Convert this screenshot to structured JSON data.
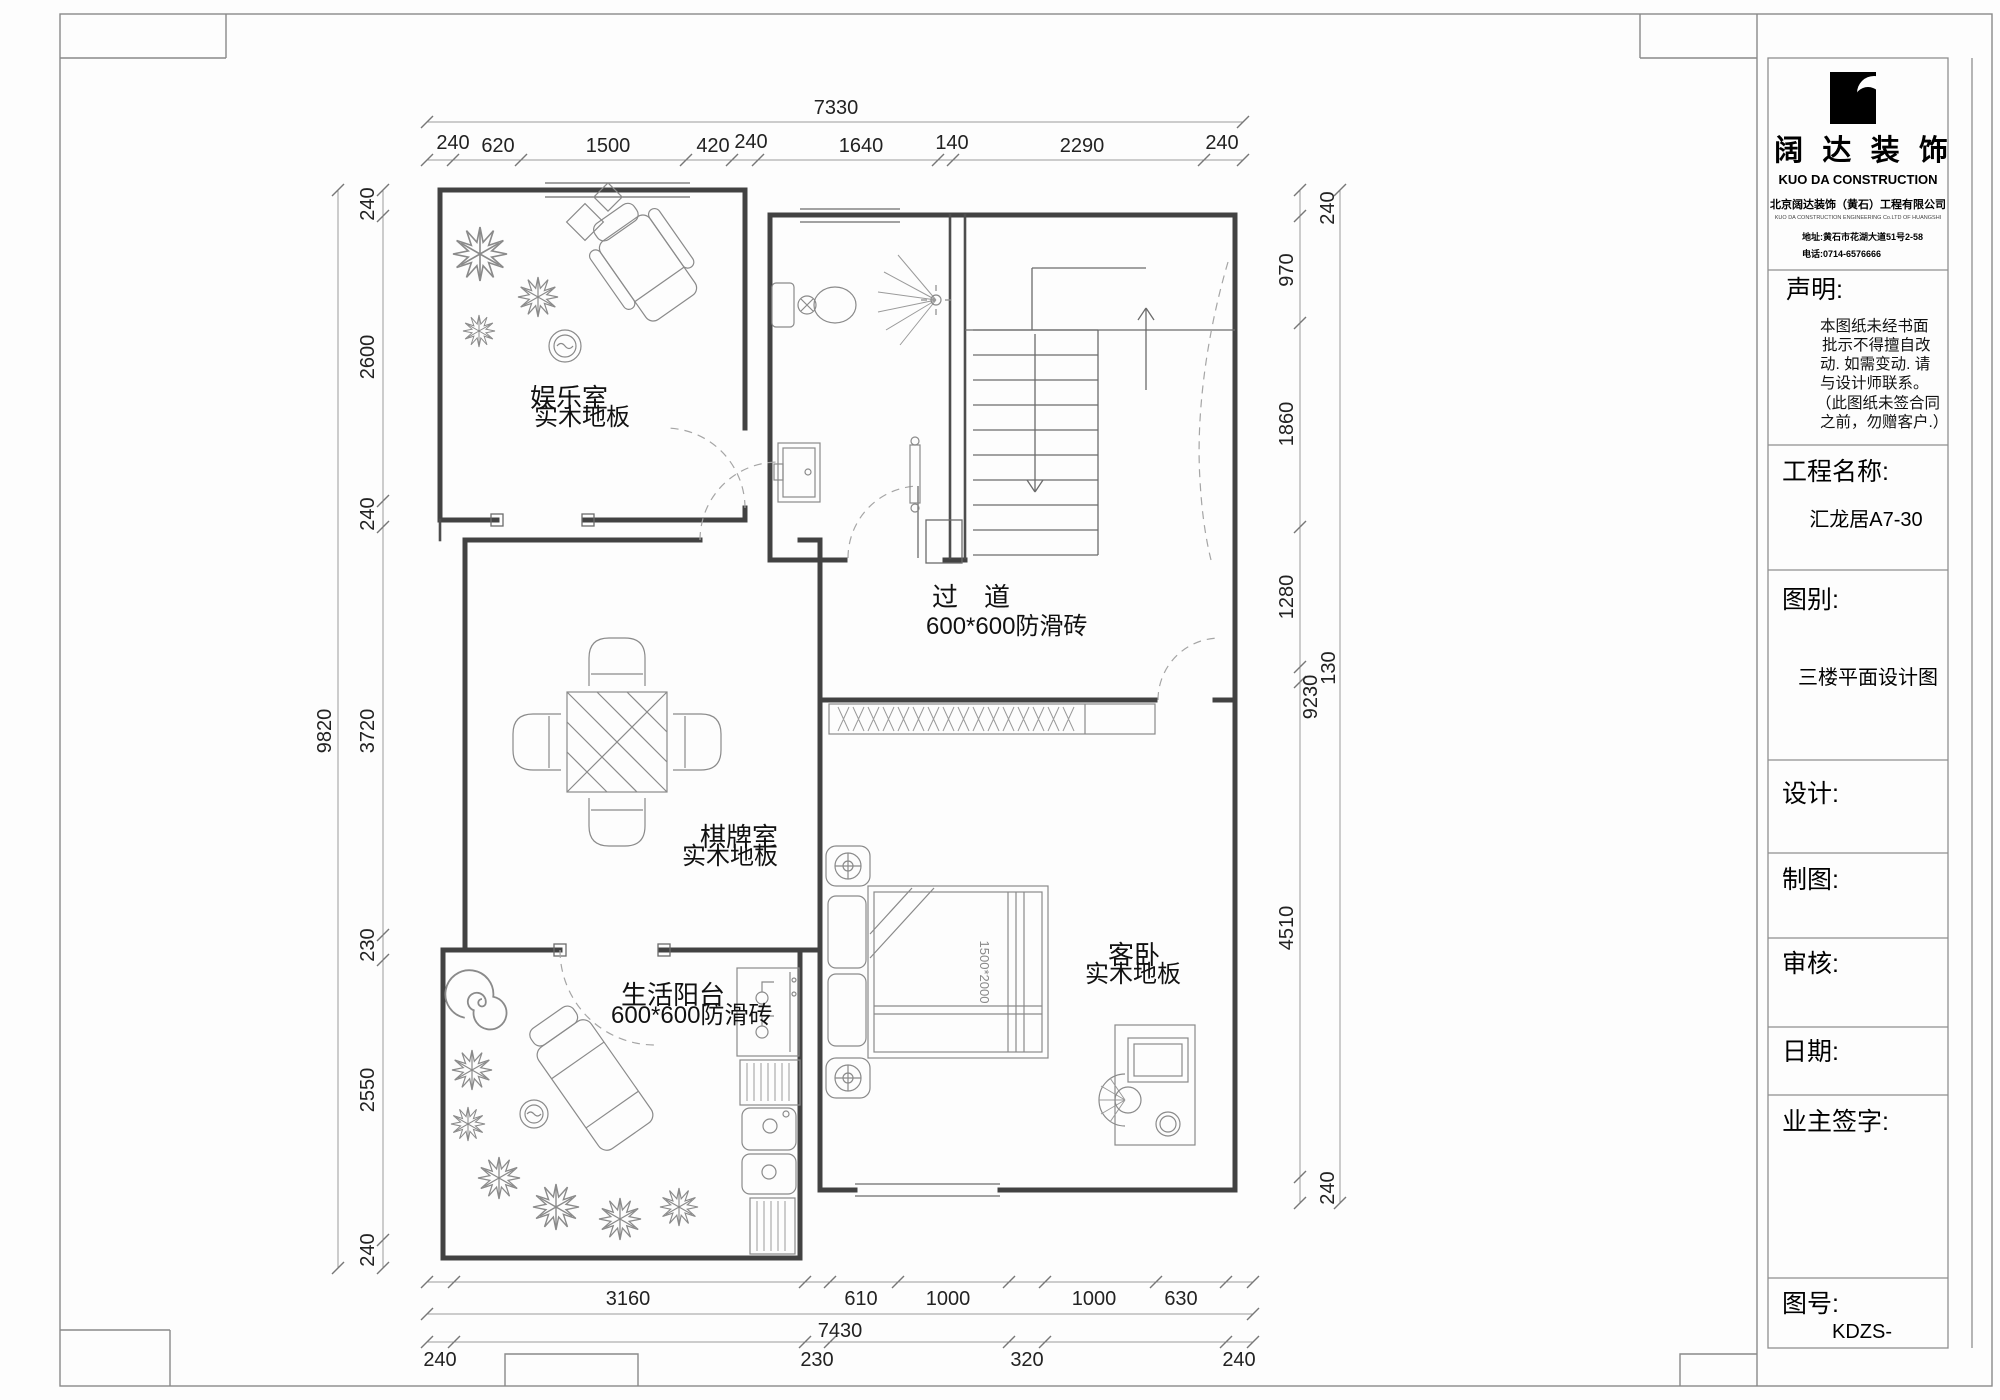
{
  "sheet": {
    "dims": {
      "top_total": "7330",
      "top": [
        "240",
        "620",
        "1500",
        "420",
        "240",
        "1640",
        "140",
        "2290",
        "240"
      ],
      "left_total": "9820",
      "left": [
        "240",
        "2600",
        "240",
        "3720",
        "230",
        "2550",
        "240"
      ],
      "right_total": "9230",
      "right_side": [
        "240",
        "970",
        "1860",
        "1280",
        "130",
        "4510",
        "240"
      ],
      "bottom_row1": [
        "3160",
        "610",
        "1000",
        "1000",
        "630"
      ],
      "bottom_total": "7430",
      "bottom_row2": [
        "240",
        "230",
        "320",
        "240"
      ]
    },
    "rooms": {
      "entertainment": {
        "name": "娱乐室",
        "floor": "实木地板"
      },
      "corridor": {
        "name": "过　道",
        "floor": "600*600防滑砖"
      },
      "chess": {
        "name": "棋牌室",
        "floor": "实木地板"
      },
      "balcony": {
        "name": "生活阳台",
        "floor": "600*600防滑砖"
      },
      "guest_bedroom": {
        "name": "客卧",
        "floor": "实木地板"
      }
    },
    "bed_size_label": "1500*2000"
  },
  "title_block": {
    "brand": {
      "name_cn": "阔 达 装 饰",
      "name_en": "KUO DA CONSTRUCTION",
      "company": "北京阔达装饰（黄石）工程有限公司",
      "company_en": "KUO DA CONSTRUCTION ENGINEERING Co.LTD OF HUANGSHI",
      "address": "地址:黄石市花湖大道51号2-58",
      "phone": "电话:0714-6576666"
    },
    "statement": {
      "label": "声明:",
      "lines": [
        "本图纸未经书面",
        "批示不得擅自改",
        "动. 如需变动. 请",
        "与设计师联系。",
        "（此图纸未签合同",
        "之前，勿赠客户.）"
      ]
    },
    "project": {
      "label": "工程名称:",
      "value": "汇龙居A7-30"
    },
    "sheet_type": {
      "label": "图别:",
      "value": "三楼平面设计图"
    },
    "designer": {
      "label": "设计:"
    },
    "drafter": {
      "label": "制图:"
    },
    "reviewer": {
      "label": "审核:"
    },
    "date": {
      "label": "日期:"
    },
    "owner": {
      "label": "业主签字:"
    },
    "sheet_no": {
      "label": "图号:",
      "value": "KDZS-"
    }
  }
}
